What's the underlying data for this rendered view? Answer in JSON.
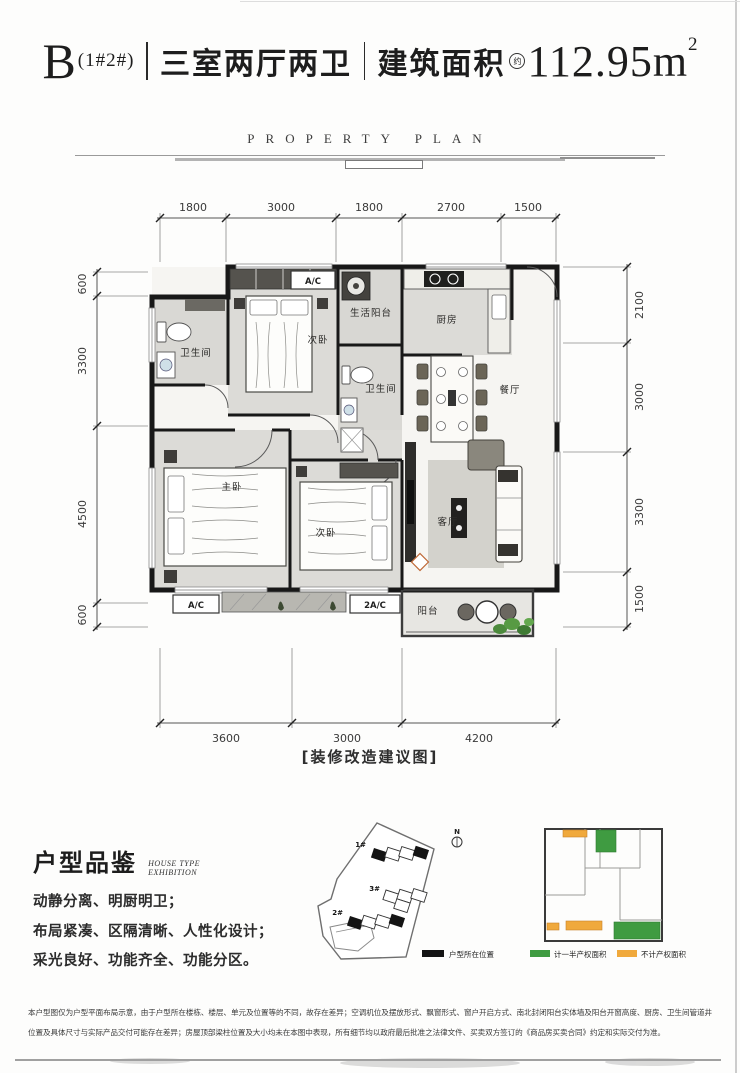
{
  "header": {
    "code": "B",
    "code_sub": "(1#2#)",
    "rooms": "三室两厅两卫",
    "area_label": "建筑面积",
    "area_note": "约",
    "area_value": "112.95m",
    "area_sup": "2"
  },
  "subtitle": "PROPERTY PLAN",
  "plan": {
    "dims_top": [
      "1800",
      "3000",
      "1800",
      "2700",
      "1500"
    ],
    "dims_left": [
      "600",
      "3300",
      "4500",
      "600"
    ],
    "dims_right": [
      "2100",
      "3000",
      "3300",
      "1500"
    ],
    "dims_bottom": [
      "3600",
      "3000",
      "4200"
    ],
    "rooms": [
      {
        "label": "卫生间"
      },
      {
        "label": "次卧"
      },
      {
        "label": "生活阳台"
      },
      {
        "label": "厨房"
      },
      {
        "label": "卫生间"
      },
      {
        "label": "餐厅"
      },
      {
        "label": "主卧"
      },
      {
        "label": "次卧"
      },
      {
        "label": "客厅"
      },
      {
        "label": "阳台"
      }
    ],
    "ac_top": "A/C",
    "ac_left": "A/C",
    "ac_right": "2A/C",
    "caption": "[装修改造建议图]"
  },
  "exhibition": {
    "title": "户型品鉴",
    "subtitle_line1": "HOUSE TYPE",
    "subtitle_line2": "EXHIBITION",
    "features": [
      "动静分离、明厨明卫；",
      "布局紧凑、区隔清晰、人性化设计；",
      "采光良好、功能齐全、功能分区。"
    ]
  },
  "site_map": {
    "north": "N",
    "buildings": [
      "1#",
      "3#",
      "2#"
    ],
    "legend_label": "户型所在位置",
    "highlight_color": "#141414"
  },
  "mini_plan": {
    "legend_half": "计一半产权面积",
    "legend_excluded": "不计产权面积",
    "green": "#3f9b41",
    "orange": "#f0a93c"
  },
  "disclaimer": [
    "本户型图仅为户型平面布局示意，由于户型所在楼栋、楼层、单元及位置等的不同，故存在差异；空调机位及摆放形式、飘窗形式、窗户开启方式、南北封闭阳台实体墙及阳台开窗高度、厨房、卫生间",
    "管道井位置及具体尺寸与实际产品交付可能存在差异；房屋顶部梁柱位置及大小均未在本图中表现，所有细节均以政府最后批准之法律文件、买卖双方签订的《商品房买卖合同》约定和实际交付为准。"
  ]
}
